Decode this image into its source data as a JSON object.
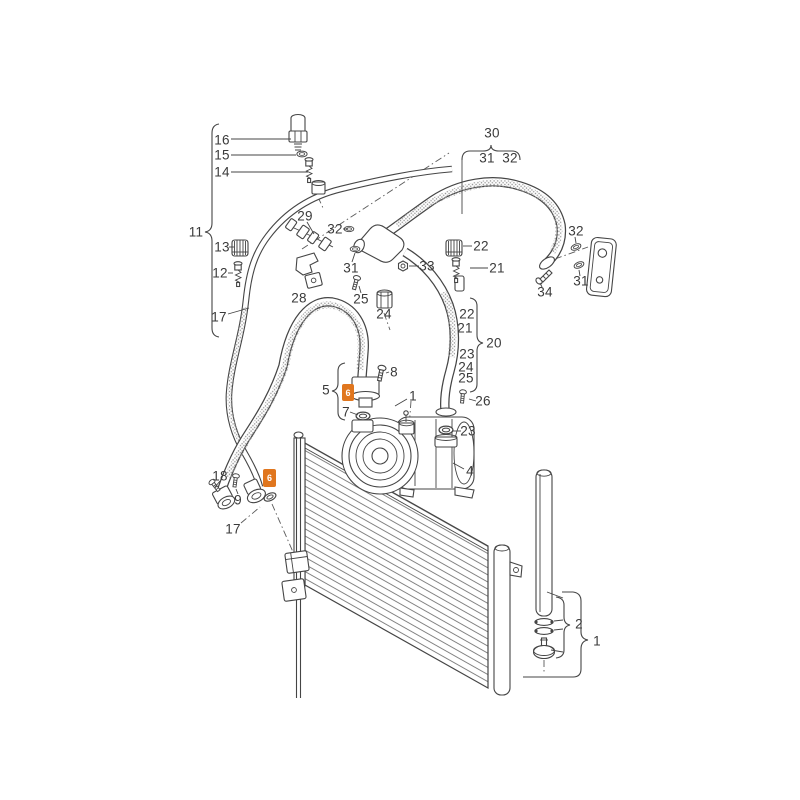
{
  "colors": {
    "accent": "#e0761e",
    "diagram_line": "#454545",
    "label_text": "#3a3a3a",
    "background": "#ffffff",
    "highlight_text": "#ffffff"
  },
  "diagram": {
    "labels": [
      {
        "text": "16",
        "x": 222,
        "y": 140
      },
      {
        "text": "15",
        "x": 222,
        "y": 155
      },
      {
        "text": "14",
        "x": 222,
        "y": 172
      },
      {
        "text": "11",
        "x": 196,
        "y": 232
      },
      {
        "text": "13",
        "x": 222,
        "y": 247
      },
      {
        "text": "12",
        "x": 220,
        "y": 273
      },
      {
        "text": "17",
        "x": 219,
        "y": 317
      },
      {
        "text": "29",
        "x": 305,
        "y": 216
      },
      {
        "text": "32",
        "x": 335,
        "y": 229
      },
      {
        "text": "31",
        "x": 351,
        "y": 268
      },
      {
        "text": "33",
        "x": 427,
        "y": 266
      },
      {
        "text": "25",
        "x": 361,
        "y": 299
      },
      {
        "text": "24",
        "x": 384,
        "y": 314
      },
      {
        "text": "28",
        "x": 299,
        "y": 298
      },
      {
        "text": "30",
        "x": 492,
        "y": 133
      },
      {
        "text": "31",
        "x": 487,
        "y": 158
      },
      {
        "text": "32",
        "x": 510,
        "y": 158
      },
      {
        "text": "22",
        "x": 481,
        "y": 246
      },
      {
        "text": "21",
        "x": 497,
        "y": 268
      },
      {
        "text": "32",
        "x": 576,
        "y": 231
      },
      {
        "text": "31",
        "x": 581,
        "y": 281
      },
      {
        "text": "34",
        "x": 545,
        "y": 292
      },
      {
        "text": "22",
        "x": 467,
        "y": 314
      },
      {
        "text": "21",
        "x": 465,
        "y": 328
      },
      {
        "text": "20",
        "x": 494,
        "y": 343
      },
      {
        "text": "23",
        "x": 467,
        "y": 354
      },
      {
        "text": "24",
        "x": 466,
        "y": 367
      },
      {
        "text": "25",
        "x": 466,
        "y": 378
      },
      {
        "text": "26",
        "x": 483,
        "y": 401
      },
      {
        "text": "8",
        "x": 394,
        "y": 372
      },
      {
        "text": "5",
        "x": 326,
        "y": 390
      },
      {
        "text": "7",
        "x": 346,
        "y": 412
      },
      {
        "text": "1",
        "x": 413,
        "y": 396
      },
      {
        "text": "23",
        "x": 468,
        "y": 431
      },
      {
        "text": "4",
        "x": 470,
        "y": 471
      },
      {
        "text": "18",
        "x": 220,
        "y": 476
      },
      {
        "text": "9",
        "x": 238,
        "y": 500
      },
      {
        "text": "17",
        "x": 233,
        "y": 529
      },
      {
        "text": "2",
        "x": 579,
        "y": 624
      },
      {
        "text": "1",
        "x": 597,
        "y": 641
      }
    ],
    "highlights": [
      {
        "text": "6",
        "x": 342,
        "y": 384,
        "w": 12,
        "h": 17
      },
      {
        "text": "6",
        "x": 263,
        "y": 469,
        "w": 13,
        "h": 18
      }
    ]
  }
}
